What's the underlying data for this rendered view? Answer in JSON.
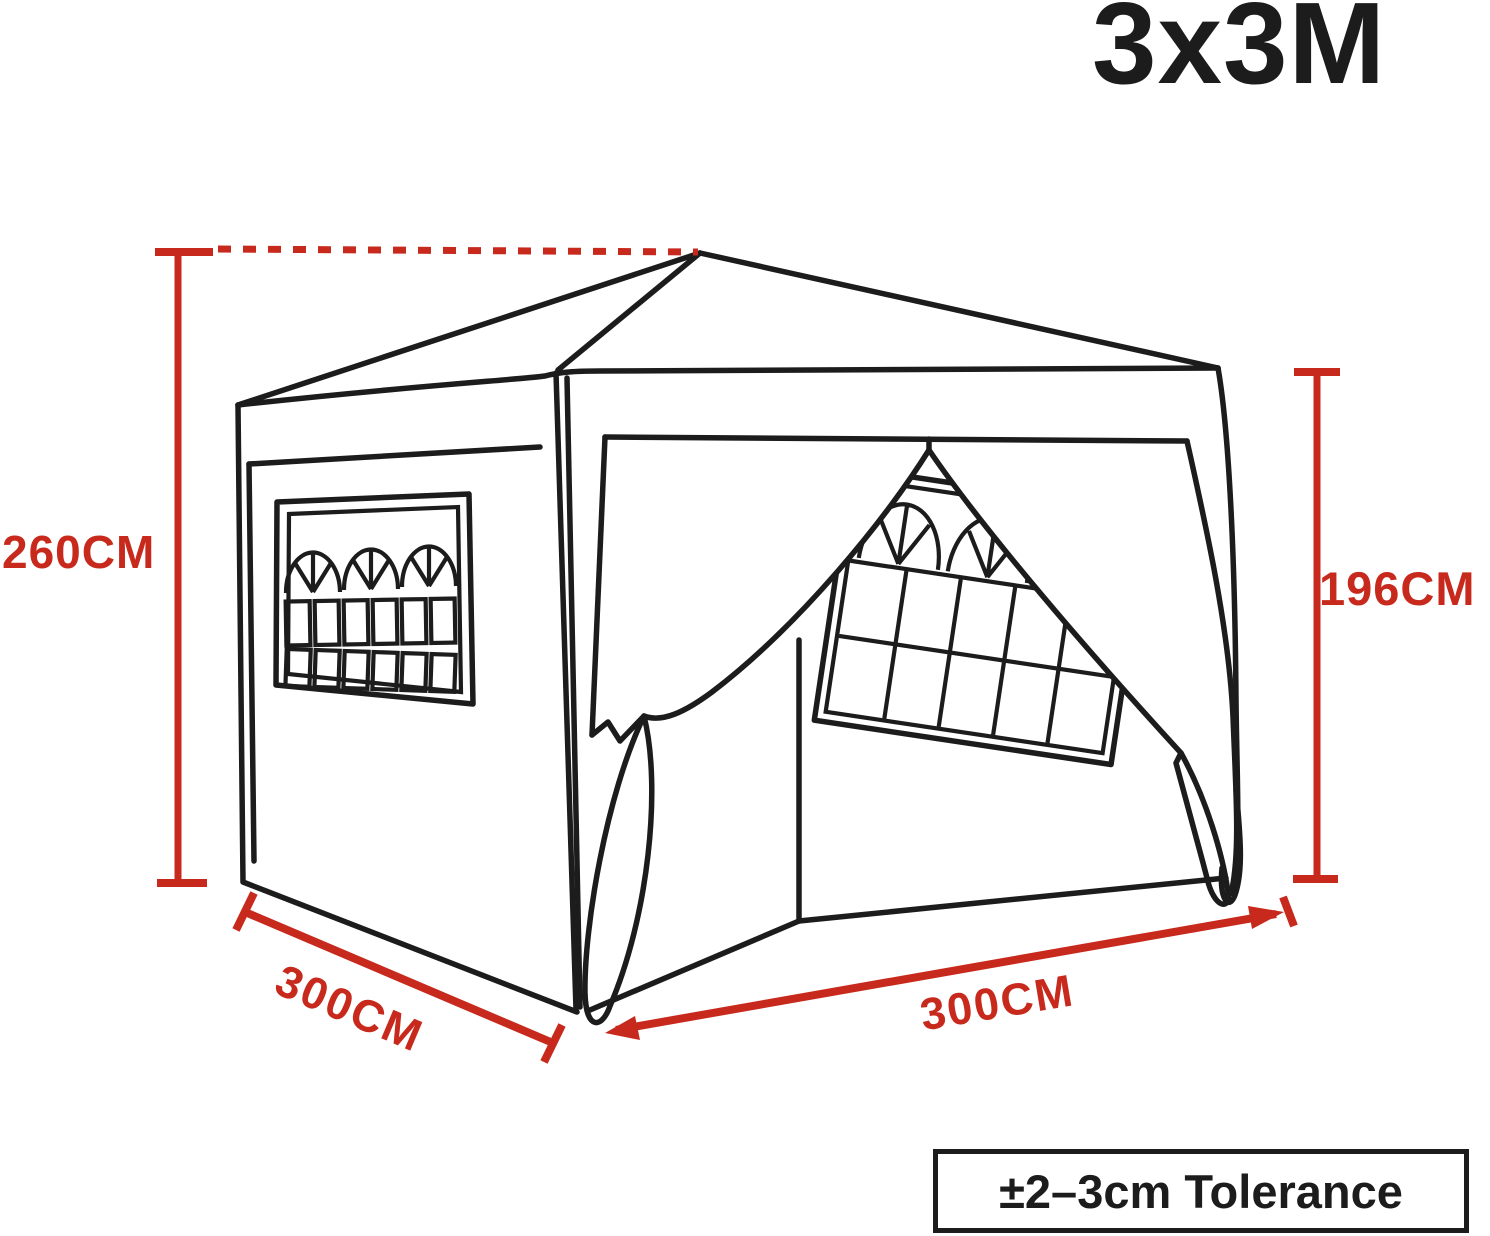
{
  "title": {
    "label": "3x3M"
  },
  "dimensions": {
    "total_height": {
      "label": "260CM"
    },
    "side_height": {
      "label": "196CM"
    },
    "depth": {
      "label": "300CM"
    },
    "width": {
      "label": "300CM"
    }
  },
  "tolerance": {
    "label": "±2–3cm Tolerance"
  },
  "colors": {
    "dimension_red": "#c8291d",
    "outline_black": "#1c1c1c",
    "background": "#ffffff"
  },
  "diagram": {
    "subject": "3x3m pop-up gazebo line drawing with arched windows and open front curtains"
  }
}
